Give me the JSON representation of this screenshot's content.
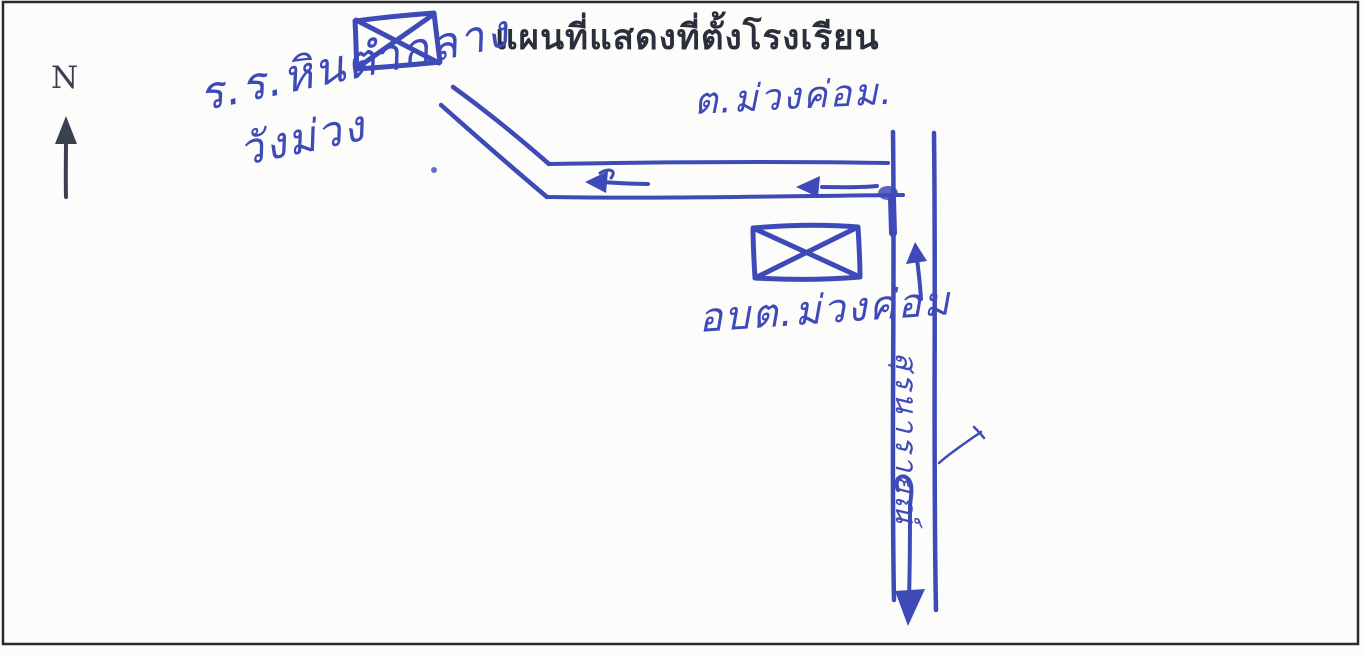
{
  "title": "แผนที่แสดงที่ตั้งโรงเรียน",
  "compass": {
    "label": "N",
    "icon": "north-up-arrow"
  },
  "school": {
    "label_line1": "ร.ร.หินตำกลาง",
    "label_line2": "วังม่วง",
    "icon": "crossed-rectangle-building"
  },
  "subdistrict": {
    "label": "ต.ม่วงค่อม."
  },
  "sao": {
    "label": "อบต.ม่วงค่อม",
    "icon": "crossed-rectangle-building"
  },
  "road": {
    "label": "สุรนารายณ์",
    "orientation": "vertical",
    "arrows": [
      "west-arrow",
      "west-arrow",
      "north-arrow",
      "south-arrow"
    ]
  },
  "colors": {
    "ink_blue": "#3e4ab8",
    "ink_dark": "#2b2f3b",
    "compass_dark": "#3a4050",
    "border_dark": "#2b2b2b",
    "paper": "#fcfcfa"
  }
}
